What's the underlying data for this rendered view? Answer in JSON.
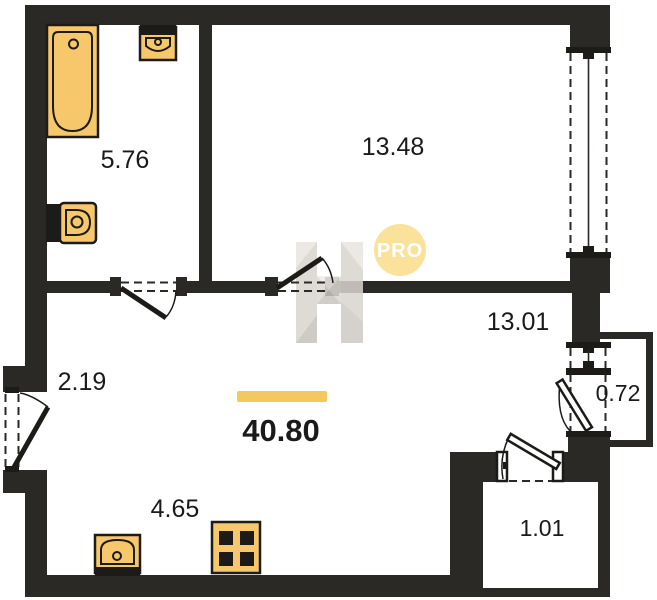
{
  "plan": {
    "total_area": {
      "value": "40.80"
    },
    "rooms": {
      "bathroom": {
        "area": "5.76"
      },
      "bedroom": {
        "area": "13.48"
      },
      "living": {
        "area": "13.01"
      },
      "hallway": {
        "area": "2.19"
      },
      "kitchen": {
        "area": "4.65"
      },
      "balcony": {
        "area": "0.72"
      },
      "closet": {
        "area": "1.01"
      }
    },
    "watermark": {
      "badge": "PRO",
      "logo_letter": "H"
    },
    "fixtures": [
      "bathtub",
      "wall-sink",
      "toilet",
      "kitchen-sink",
      "stove",
      "entrance-door",
      "bathroom-door",
      "bedroom-door",
      "balcony-door",
      "closet-door",
      "bedroom-window",
      "balcony-window"
    ],
    "colors": {
      "wall": "#2b2926",
      "fixture_fill": "#f6c76b",
      "fixture_outline": "#1d1b18",
      "accent_bar": "#f4c85e",
      "pro_badge_fill": "#fbe29a",
      "pro_badge_text": "#ffffff",
      "watermark_gray": "#d9d4ce",
      "label_text": "#1a1a1a",
      "background": "#ffffff"
    }
  }
}
